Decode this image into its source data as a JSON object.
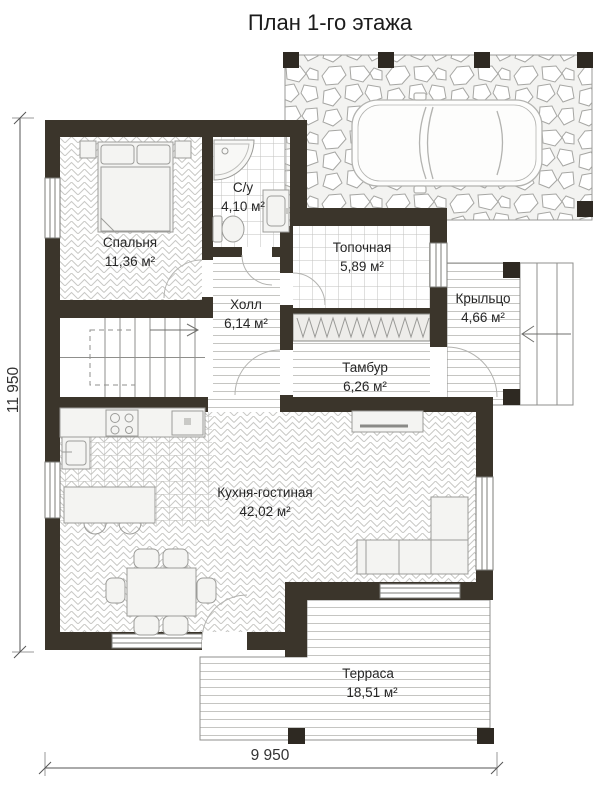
{
  "title": "План 1-го этажа",
  "rooms": {
    "bedroom": {
      "name": "Спальня",
      "area": "11,36 м²"
    },
    "bathroom": {
      "name": "С/у",
      "area": "4,10 м²"
    },
    "boiler": {
      "name": "Топочная",
      "area": "5,89 м²"
    },
    "hall": {
      "name": "Холл",
      "area": "6,14 м²"
    },
    "vestibule": {
      "name": "Тамбур",
      "area": "6,26 м²"
    },
    "porch": {
      "name": "Крыльцо",
      "area": "4,66 м²"
    },
    "kitchen_living": {
      "name": "Кухня-гостиная",
      "area": "42,02 м²"
    },
    "terrace": {
      "name": "Терраса",
      "area": "18,51 м²"
    }
  },
  "dimensions": {
    "overall_height": "11 950",
    "overall_width": "9 950"
  },
  "colors": {
    "wall": "#3b352b",
    "floor_line": "#c6c6c3",
    "text": "#262626"
  }
}
